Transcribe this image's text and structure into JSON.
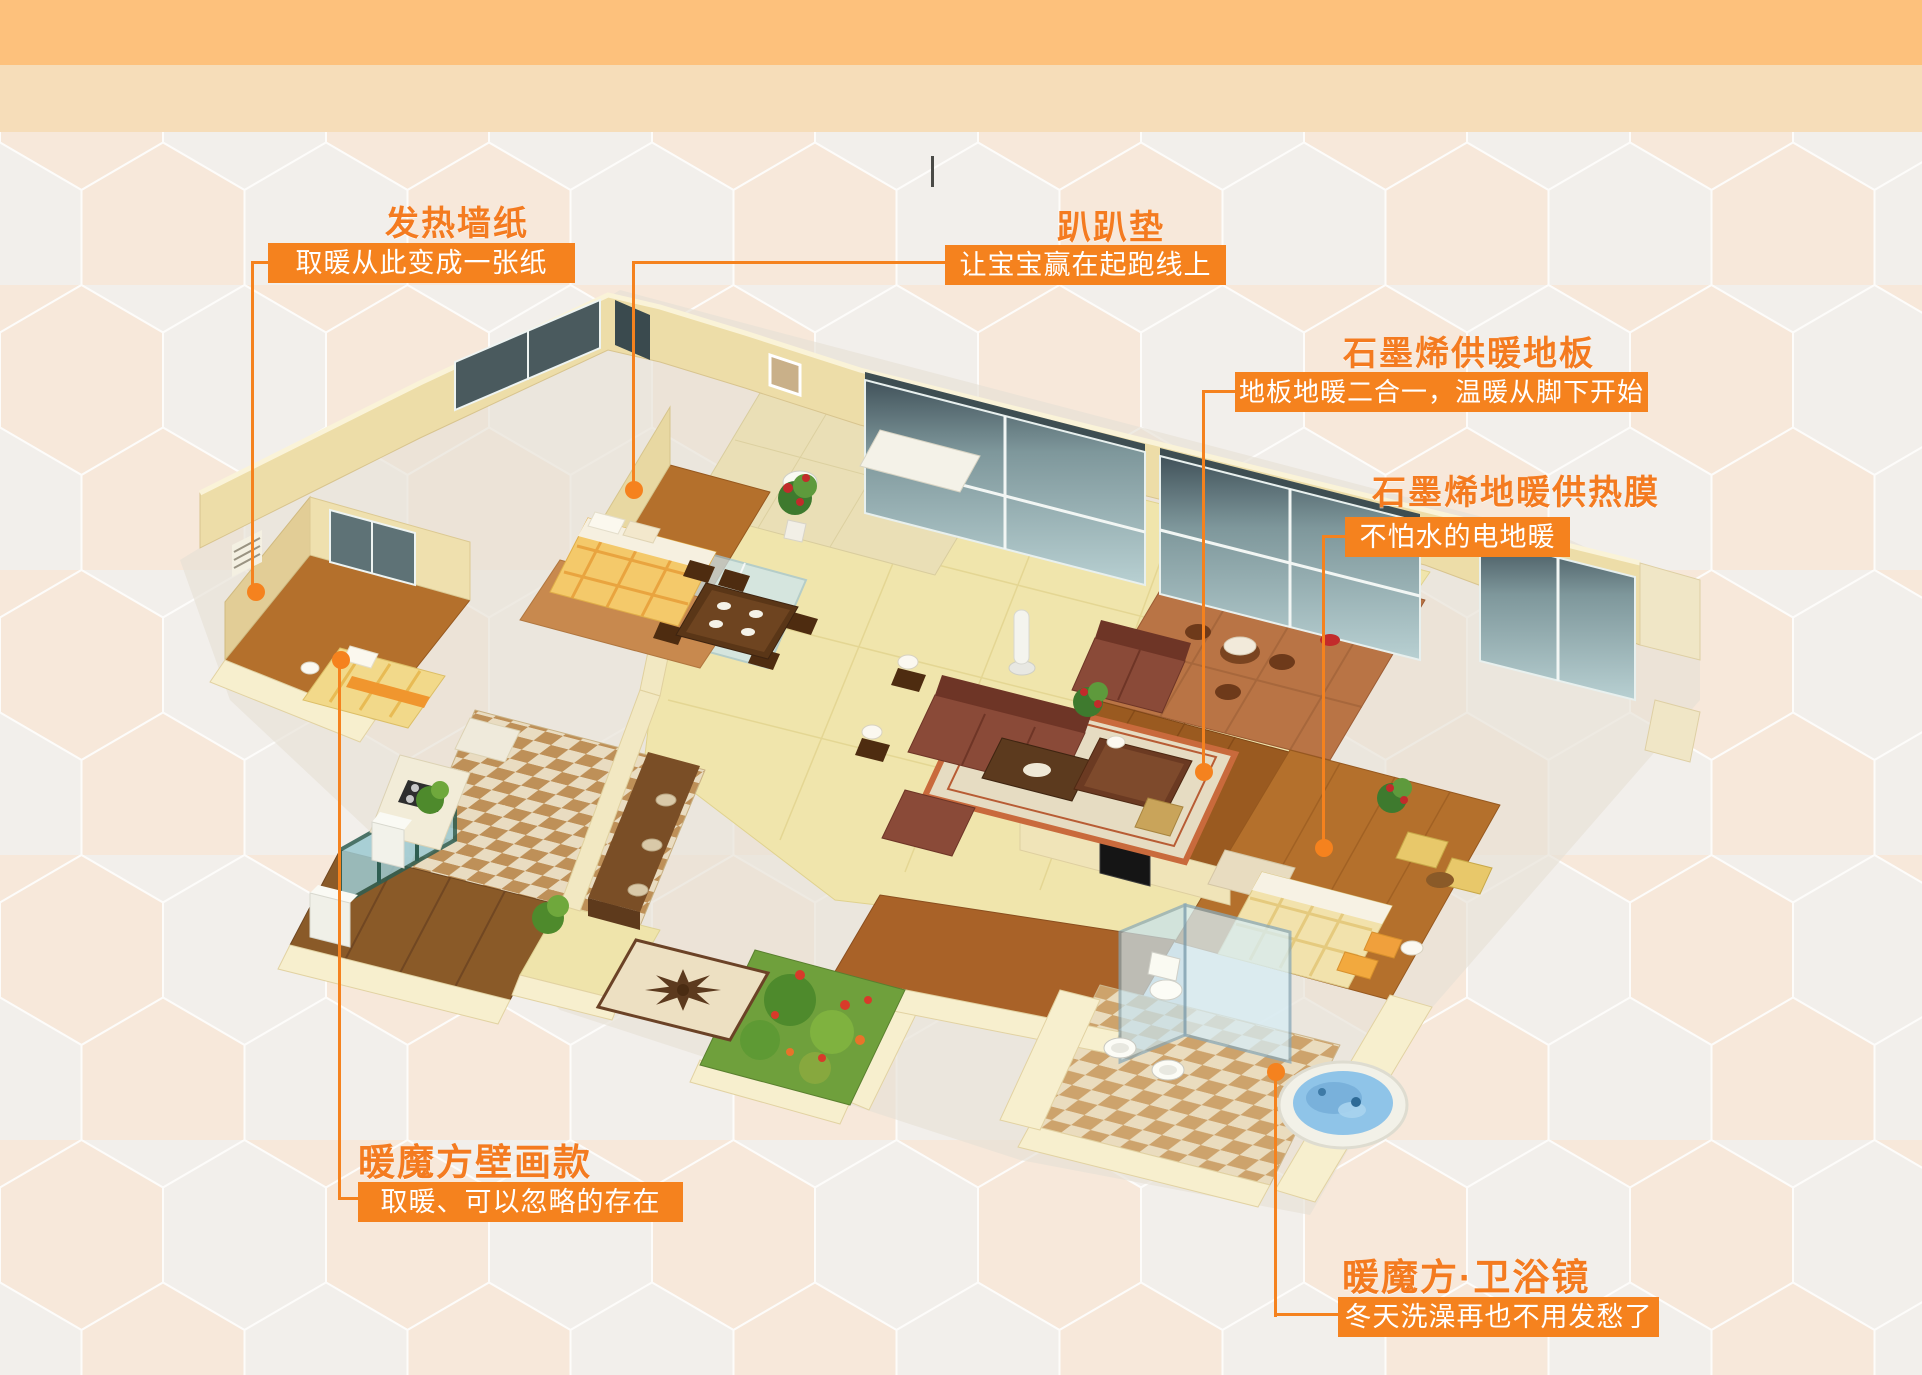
{
  "colors": {
    "accent_orange": "#F5821E",
    "title_orange": "#F47B20",
    "header_band_top": "#FDC17C",
    "header_band_bottom": "#F6DDB9",
    "background_base": "#F3EAE0",
    "hexagon_light": "#F2F0ED",
    "hexagon_peach": "#F8E8D9"
  },
  "callouts": [
    {
      "id": "heating-wallpaper",
      "title": "发热墙纸",
      "subtitle": "取暖从此变成一张纸"
    },
    {
      "id": "crawl-mat",
      "title": "趴趴垫",
      "subtitle": "让宝宝赢在起跑线上"
    },
    {
      "id": "graphene-floorboard",
      "title": "石墨烯供暖地板",
      "subtitle": "地板地暖二合一，温暖从脚下开始"
    },
    {
      "id": "graphene-heat-film",
      "title": "石墨烯地暖供热膜",
      "subtitle": "不怕水的电地暖"
    },
    {
      "id": "warm-cube-mural",
      "title": "暖魔方壁画款",
      "subtitle": "取暖、可以忽略的存在"
    },
    {
      "id": "warm-cube-mirror",
      "title": "暖魔方·卫浴镜",
      "subtitle": "冬天洗澡再也不用发愁了"
    }
  ]
}
